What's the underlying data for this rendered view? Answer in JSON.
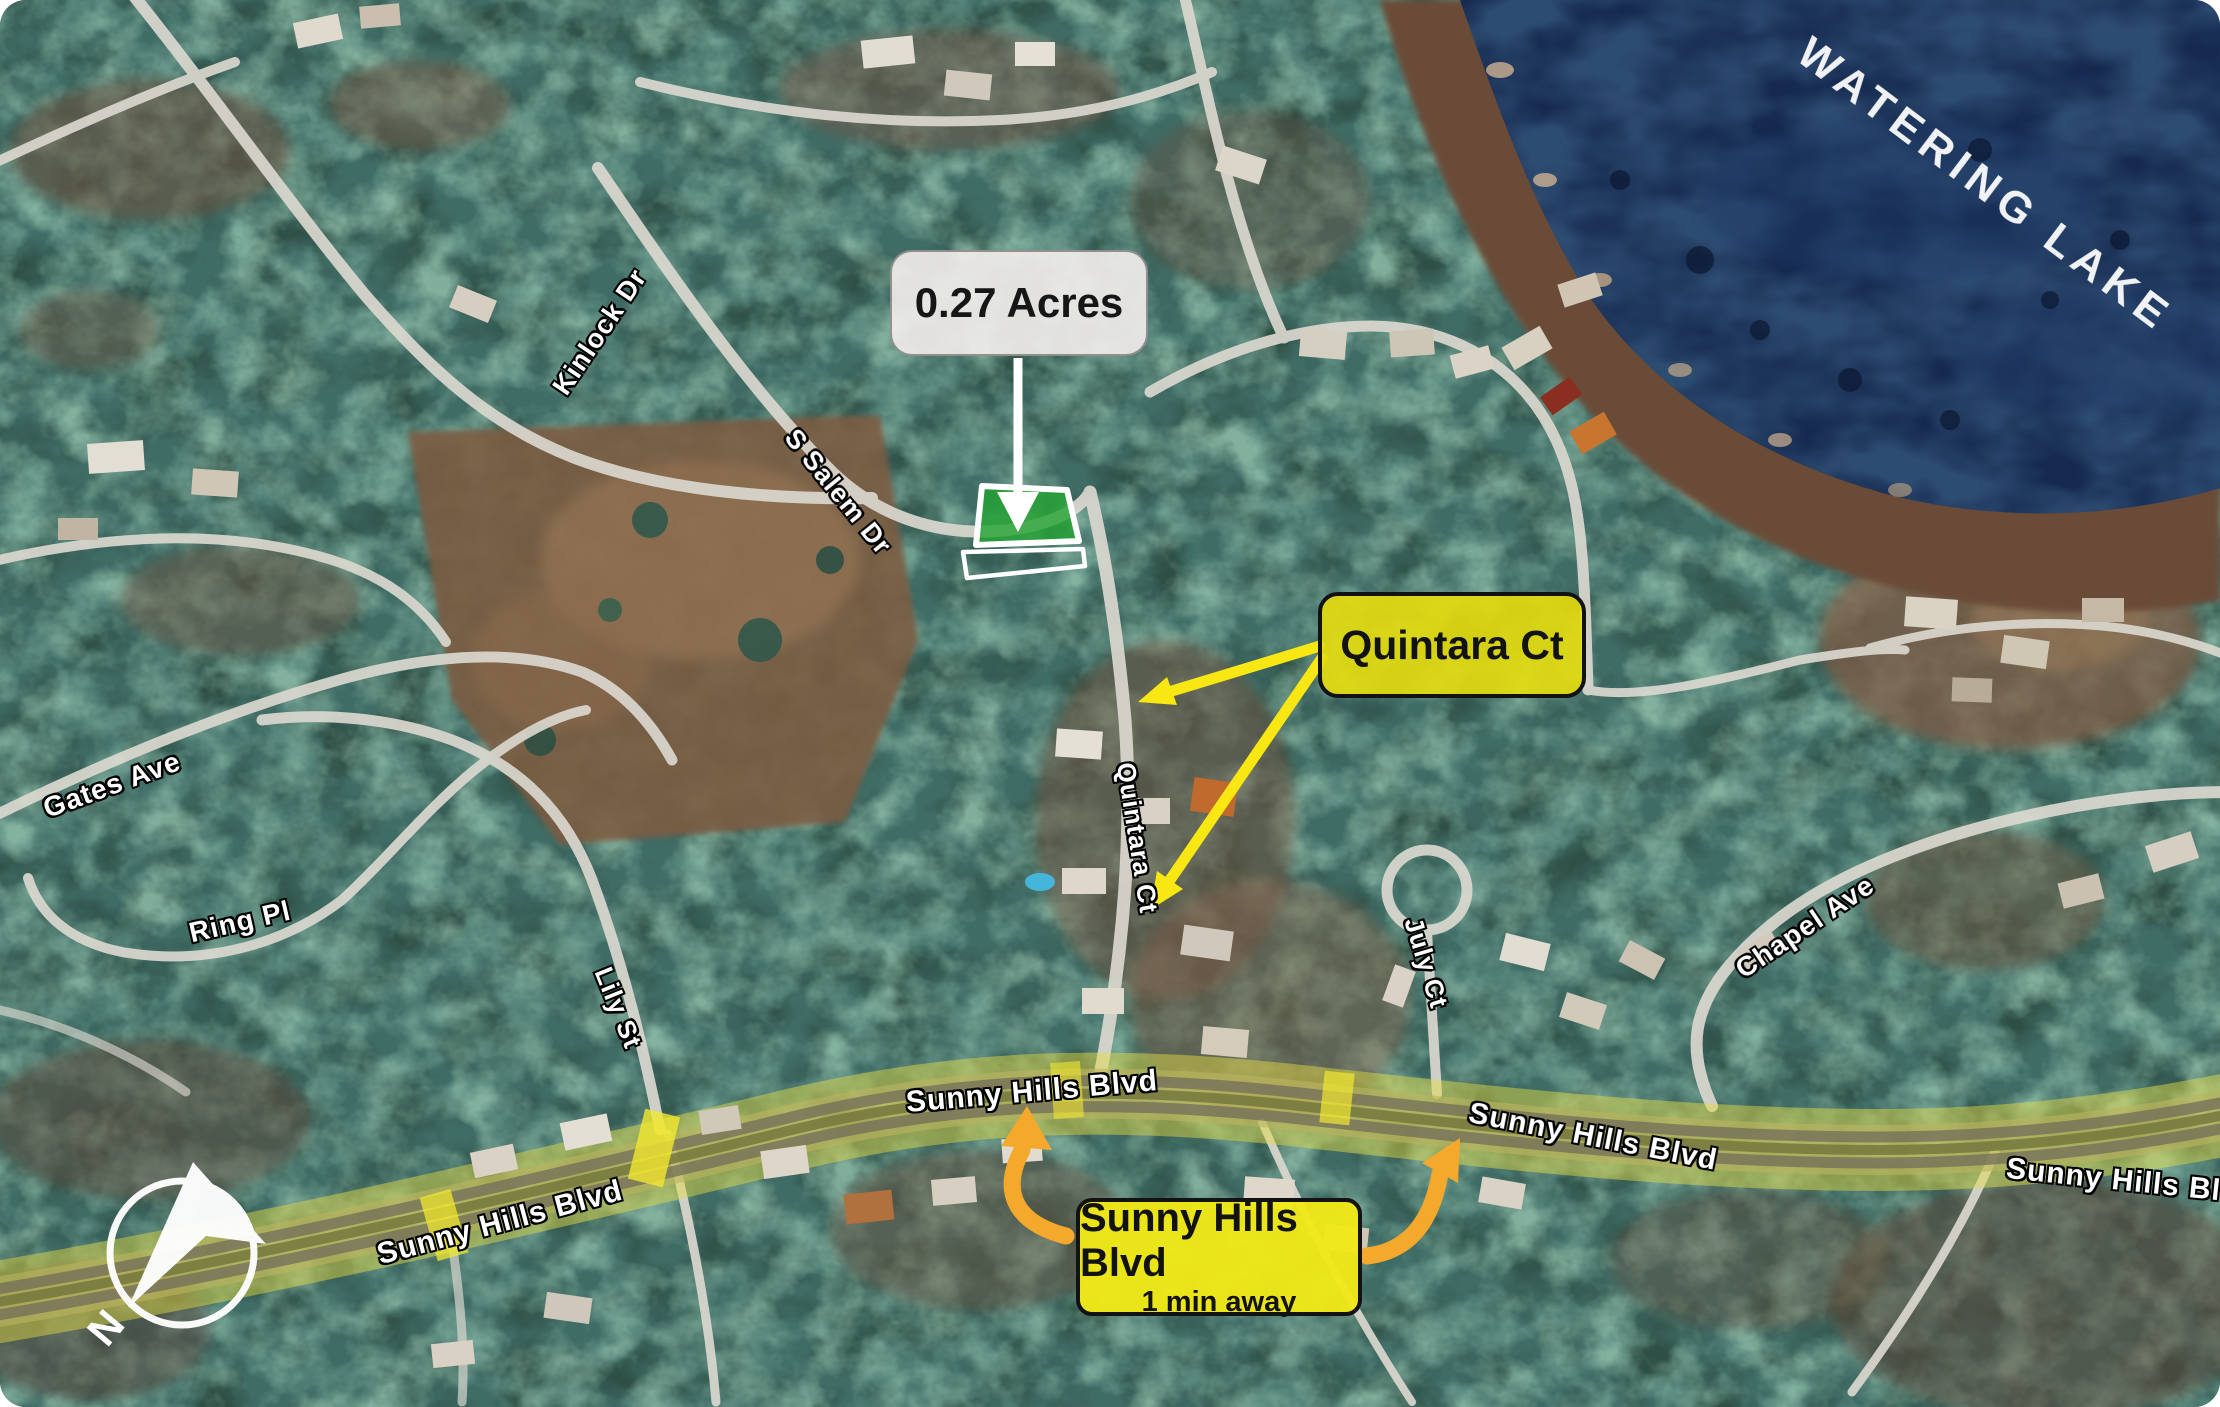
{
  "parcel_callout": {
    "area_label": "0.27 Acres"
  },
  "quintara_callout": {
    "label": "Quintara Ct"
  },
  "route_callout": {
    "label": "Sunny Hills Blvd",
    "sublabel": "1 min away"
  },
  "lake_label": "WATERING LAKE",
  "compass": {
    "north_label": "N"
  },
  "street_labels": [
    {
      "id": "kinlock",
      "text": "Kinlock Dr"
    },
    {
      "id": "s-salem",
      "text": "S Salem Dr"
    },
    {
      "id": "gates",
      "text": "Gates Ave"
    },
    {
      "id": "ring",
      "text": "Ring Pl"
    },
    {
      "id": "lily",
      "text": "Lily St"
    },
    {
      "id": "quintara-street",
      "text": "Quintara Ct"
    },
    {
      "id": "july",
      "text": "July Ct"
    },
    {
      "id": "chapel",
      "text": "Chapel Ave"
    },
    {
      "id": "sunny-left",
      "text": "Sunny Hills Blvd"
    },
    {
      "id": "sunny-center",
      "text": "Sunny Hills Blvd"
    },
    {
      "id": "sunny-right",
      "text": "Sunny Hills Blvd"
    },
    {
      "id": "sunny-far-right",
      "text": "Sunny Hills Blvd"
    }
  ],
  "colors": {
    "forest_green": "#2e4f45",
    "water_navy": "#16294e",
    "parcel_green": "#22a331",
    "callout_yellow": "#e8e014",
    "arrow_yellow": "#f8e713",
    "arrow_orange": "#f5a92c",
    "road_gray": "#dbd8d0",
    "label_white": "#ffffff"
  }
}
